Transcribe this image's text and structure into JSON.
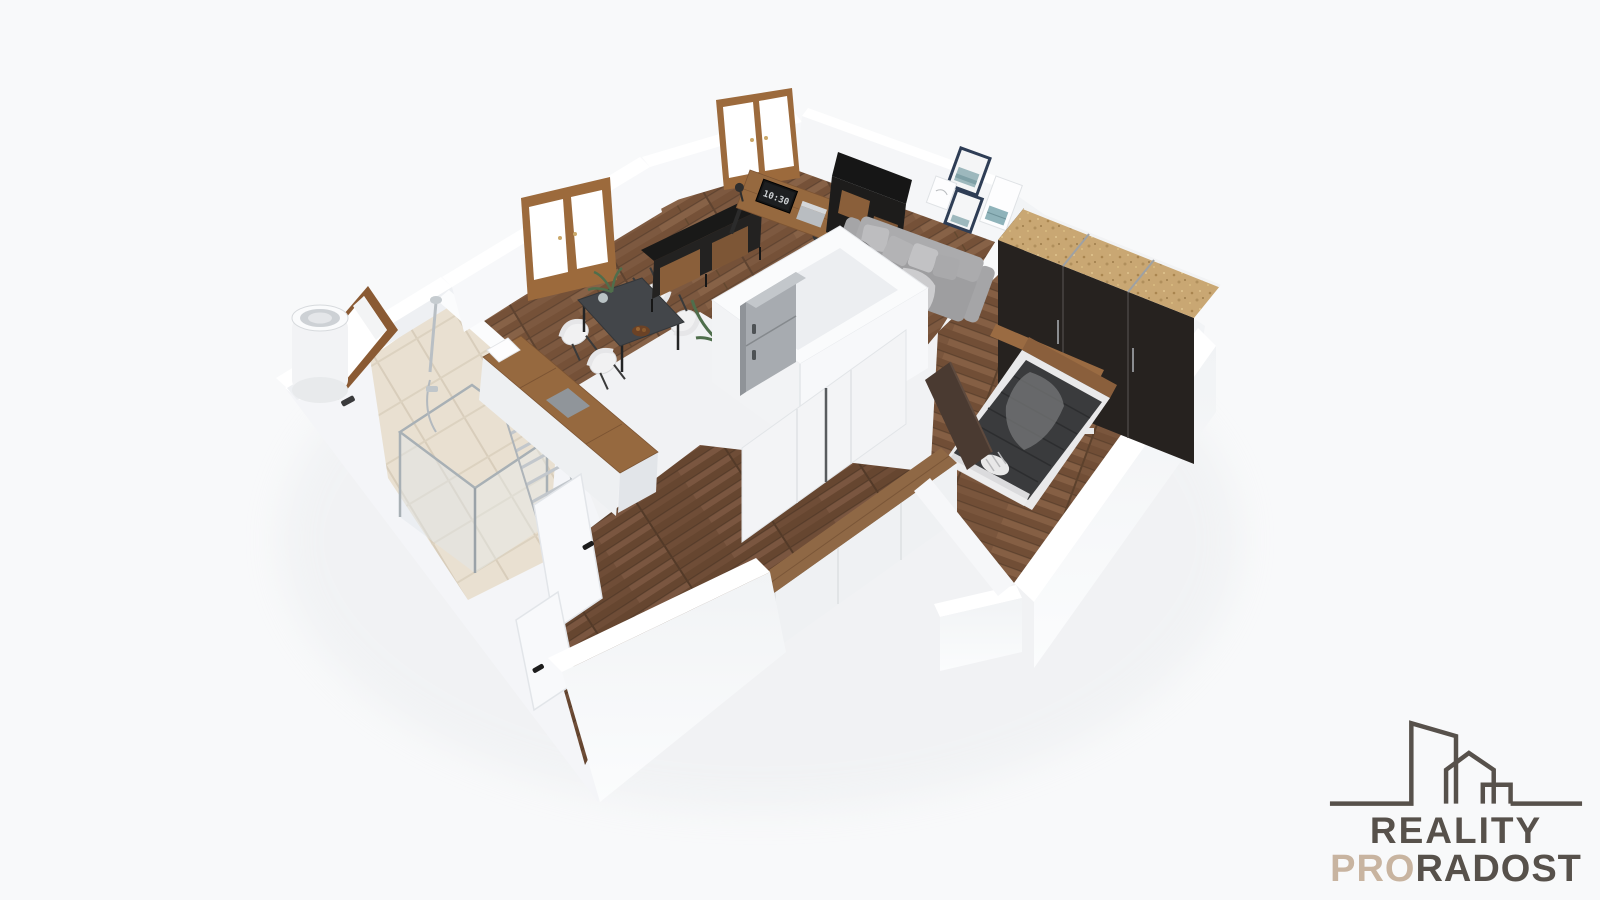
{
  "scene": {
    "description": "3D cutaway floor plan render of a one-bedroom apartment",
    "background_color": "#f8f9fa",
    "monitor_clock": "10:30",
    "palette": {
      "wall_white": "#ffffff",
      "wall_shade": "#eef0f3",
      "floor_wood": "#7b563e",
      "bathroom_tile": "#e9e0d1",
      "counter_wood": "#96693f",
      "window_frame_wood": "#9c6a3c",
      "furniture_black": "#211f1d",
      "wardrobe_top_cork": "#c9a773",
      "sofa_gray": "#a5a5a7",
      "picture_frame_navy": "#2e3d55"
    },
    "rooms": [
      {
        "name": "living-room",
        "items": [
          "desk",
          "monitor",
          "office-chair",
          "black-shelving",
          "sofa",
          "wall-frames",
          "sideboard",
          "dining-table",
          "dining-chairs",
          "potted-plant"
        ]
      },
      {
        "name": "kitchen",
        "items": [
          "counter",
          "sink",
          "fridge"
        ]
      },
      {
        "name": "bedroom",
        "items": [
          "double-bed",
          "wardrobe",
          "headboard-shelf"
        ]
      },
      {
        "name": "bathroom",
        "items": [
          "shower",
          "towel-radiator",
          "water-heater",
          "window"
        ]
      },
      {
        "name": "hallway",
        "items": [
          "storage-cabinet",
          "built-in-wardrobe",
          "doors"
        ]
      }
    ]
  },
  "logo": {
    "line1": "REALITY",
    "line2_accent": "PRO",
    "line2_rest": "RADOST",
    "text_color": "#57514b",
    "accent_color": "#c8b4a0",
    "icon": "building-skyline-icon"
  }
}
